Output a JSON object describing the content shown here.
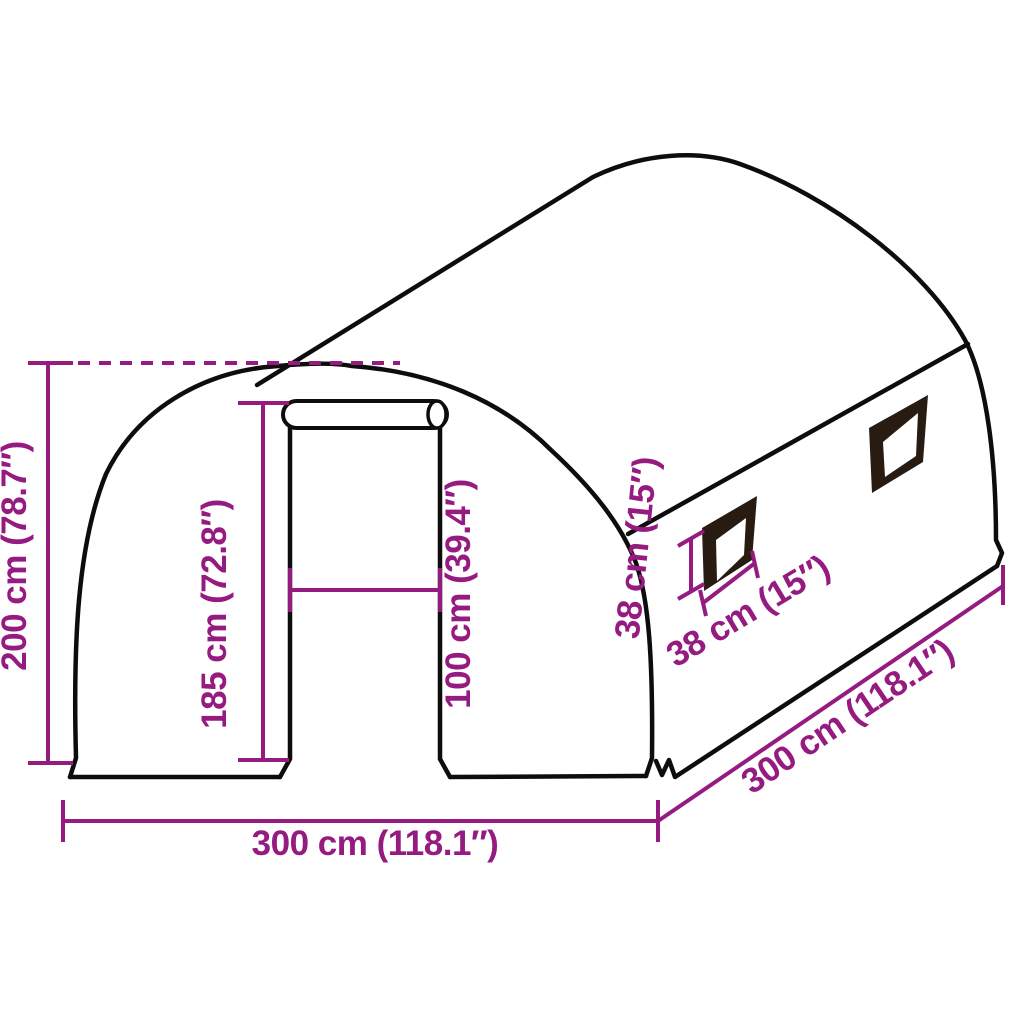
{
  "diagram": {
    "subject": "tunnel-greenhouse-dimension-diagram",
    "labels": {
      "total_height": "200 cm (78.7″)",
      "door_height": "185 cm (72.8″)",
      "door_width": "100 cm (39.4″)",
      "window_height": "38 cm (15″)",
      "window_width": "38 cm (15″)",
      "front_width": "300 cm (118.1″)",
      "side_depth": "300 cm (118.1″)"
    },
    "colors": {
      "dimension": "#951b81",
      "outline": "#0d0d0d",
      "window_frame": "#281c12",
      "background": "#ffffff"
    }
  }
}
